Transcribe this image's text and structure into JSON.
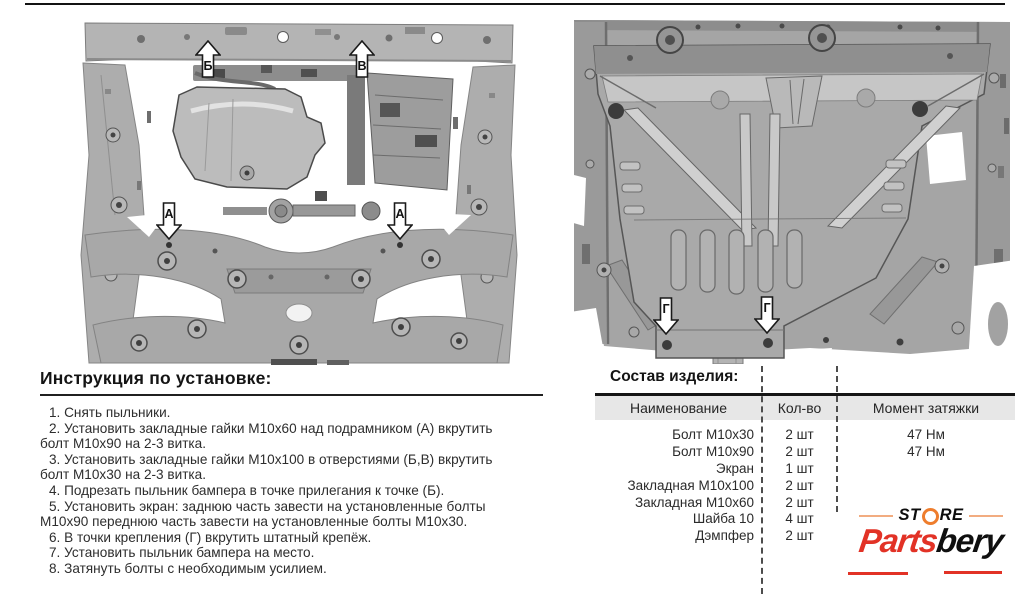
{
  "instructions": {
    "title": "Инструкция по установке:",
    "steps": [
      "1. Снять пыльники.",
      "2. Установить закладные гайки М10х60 над подрамником (А) вкрутить болт М10х90 на 2-3 витка.",
      "3. Установить закладные гайки М10х100 в отверстиями (Б,В) вкрутить болт М10х30 на 2-3 витка.",
      "4. Подрезать пыльник бампера в точке прилегания к точке (Б).",
      "5. Установить экран: заднюю часть завести на установленные болты М10х90 переднюю часть завести на установленные болты М10х30.",
      "6. В точки крепления (Г) вкрутить штатный крепёж.",
      "7. Установить пыльник бампера на место.",
      "8. Затянуть болты с необходимым усилием."
    ]
  },
  "parts_table": {
    "title": "Состав изделия:",
    "columns": [
      "Наименование",
      "Кол-во",
      "Момент затяжки"
    ],
    "rows": [
      {
        "name": "Болт М10х30",
        "qty": "2 шт",
        "torque": "47 Нм"
      },
      {
        "name": "Болт М10х90",
        "qty": "2 шт",
        "torque": "47 Нм"
      },
      {
        "name": "Экран",
        "qty": "1 шт",
        "torque": ""
      },
      {
        "name": "Закладная М10х100",
        "qty": "2 шт",
        "torque": ""
      },
      {
        "name": "Закладная М10х60",
        "qty": "2 шт",
        "torque": ""
      },
      {
        "name": "Шайба 10",
        "qty": "4 шт",
        "torque": ""
      },
      {
        "name": "Дэмпфер",
        "qty": "2 шт",
        "torque": ""
      }
    ]
  },
  "figures": {
    "left_photo_callouts": [
      "Б",
      "В",
      "А",
      "А"
    ],
    "right_drawing_callouts": [
      "Г",
      "Г"
    ]
  },
  "logo": {
    "store_left": "ST",
    "store_right": "RE",
    "name_red": "Parts",
    "name_black": "bery",
    "colors": {
      "red": "#e23226",
      "orange": "#ee7d2d"
    }
  }
}
